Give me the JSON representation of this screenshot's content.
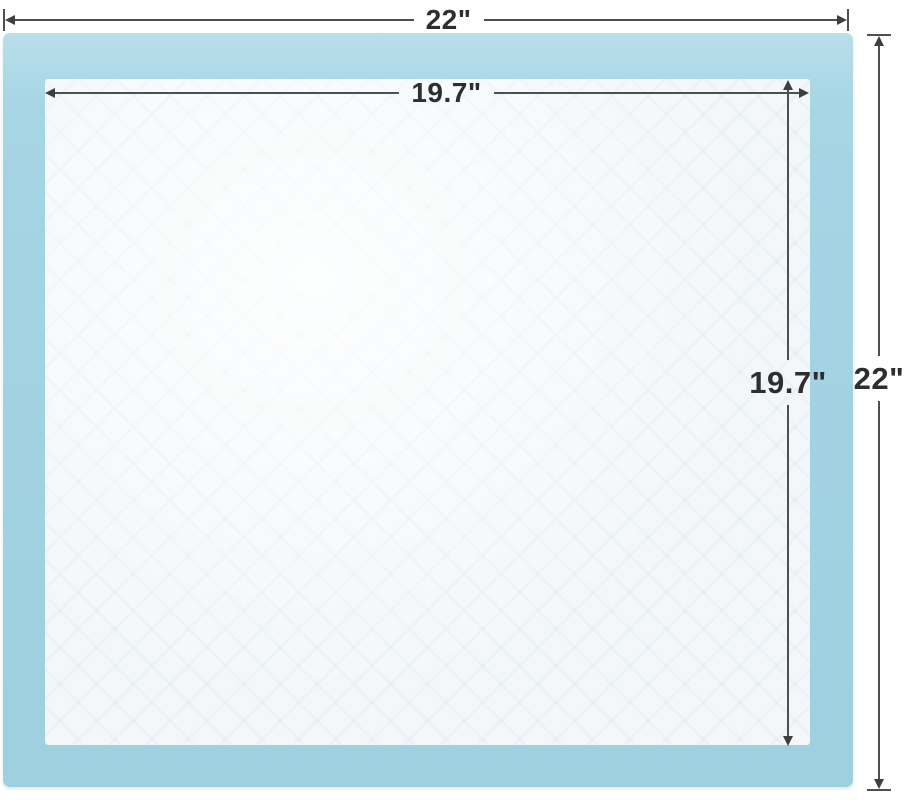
{
  "diagram": {
    "outer": {
      "width_label": "22\"",
      "height_label": "22\""
    },
    "inner": {
      "width_label": "19.7\"",
      "height_label": "19.7\""
    }
  },
  "colors": {
    "pad_border_blue": "#a4d4e3",
    "pad_border_blue_light": "#b8dfea",
    "pad_inner_surface": "#f3f7f9",
    "dimension_line": "#4f4f4f",
    "label_text": "#2e2e2e",
    "background": "#ffffff"
  }
}
